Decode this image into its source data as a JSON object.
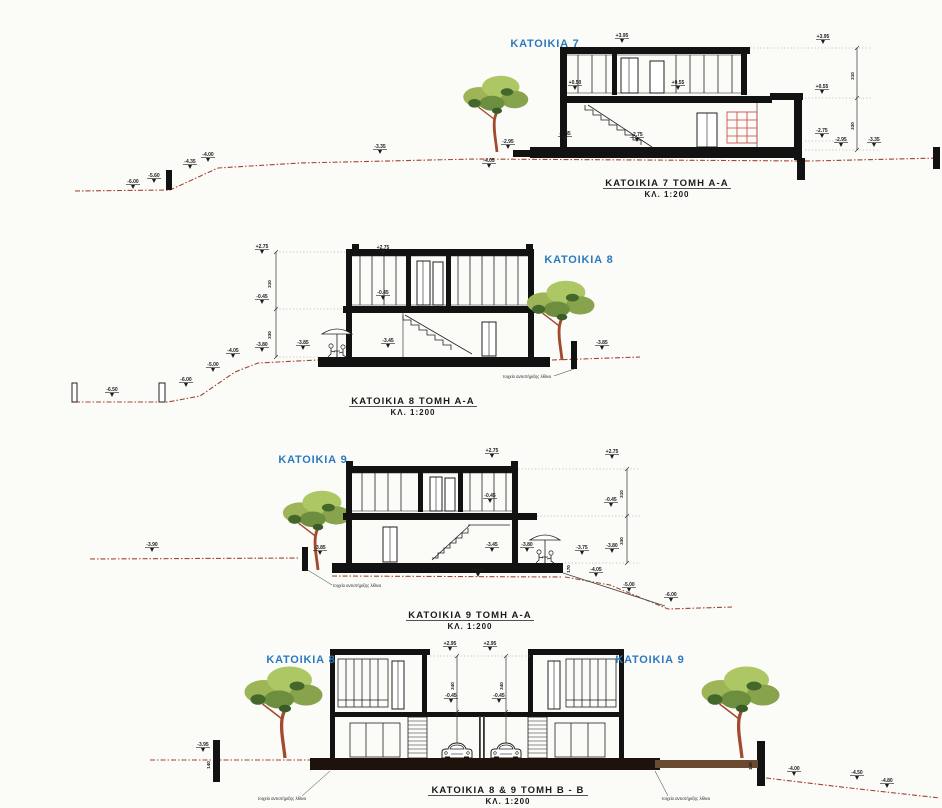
{
  "colors": {
    "accent_blue": "#2b7ac0",
    "terrain": "#a64431",
    "ink": "#121212",
    "red_hatch": "#c4413b"
  },
  "d1": {
    "house_label": "ΚΑΤΟΙΚΙΑ 7",
    "title": "ΚΑΤΟΙΚΙΑ 7  ΤΟΜΗ Α-Α",
    "scale": "ΚΛ. 1:200",
    "dims": [
      {
        "t": "310",
        "x": 854,
        "y": 76
      },
      {
        "t": "330",
        "x": 854,
        "y": 126
      }
    ],
    "markers": [
      {
        "t": "-6.00",
        "x": 133,
        "y": 183
      },
      {
        "t": "-5.60",
        "x": 154,
        "y": 177
      },
      {
        "t": "-4.35",
        "x": 190,
        "y": 163
      },
      {
        "t": "-4.00",
        "x": 208,
        "y": 156
      },
      {
        "t": "-3.35",
        "x": 380,
        "y": 148
      },
      {
        "t": "-2.95",
        "x": 508,
        "y": 143
      },
      {
        "t": "-4.05",
        "x": 489,
        "y": 162
      },
      {
        "t": "+3.95",
        "x": 622,
        "y": 37
      },
      {
        "t": "+3.95",
        "x": 823,
        "y": 38
      },
      {
        "t": "+0.50",
        "x": 575,
        "y": 84
      },
      {
        "t": "+0.55",
        "x": 678,
        "y": 84
      },
      {
        "t": "+0.55",
        "x": 822,
        "y": 88
      },
      {
        "t": "-2.85",
        "x": 565,
        "y": 135
      },
      {
        "t": "-2.75",
        "x": 637,
        "y": 136
      },
      {
        "t": "-2.75",
        "x": 822,
        "y": 132
      },
      {
        "t": "-2.95",
        "x": 841,
        "y": 141
      },
      {
        "t": "-3.35",
        "x": 874,
        "y": 141
      }
    ]
  },
  "d2": {
    "house_label": "ΚΑΤΟΙΚΙΑ 8",
    "title": "ΚΑΤΟΙΚΙΑ 8  ΤΟΜΗ Α-Α",
    "scale": "ΚΛ. 1:200",
    "note": "τοιχείο αντιστήριξης λίθινο",
    "dims": [
      {
        "t": "310",
        "x": 271,
        "y": 284
      },
      {
        "t": "330",
        "x": 271,
        "y": 335
      }
    ],
    "markers": [
      {
        "t": "-6.50",
        "x": 112,
        "y": 391
      },
      {
        "t": "-6.00",
        "x": 186,
        "y": 381
      },
      {
        "t": "-5.00",
        "x": 213,
        "y": 366
      },
      {
        "t": "-4.05",
        "x": 233,
        "y": 352
      },
      {
        "t": "-3.80",
        "x": 262,
        "y": 346
      },
      {
        "t": "-3.85",
        "x": 303,
        "y": 344
      },
      {
        "t": "+2.75",
        "x": 262,
        "y": 248
      },
      {
        "t": "+2.75",
        "x": 383,
        "y": 249
      },
      {
        "t": "-0.45",
        "x": 262,
        "y": 298
      },
      {
        "t": "-0.45",
        "x": 383,
        "y": 294
      },
      {
        "t": "-3.45",
        "x": 388,
        "y": 342
      },
      {
        "t": "-3.85",
        "x": 602,
        "y": 344
      }
    ]
  },
  "d3": {
    "house_label": "ΚΑΤΟΙΚΙΑ 9",
    "title": "ΚΑΤΟΙΚΙΑ 9  ΤΟΜΗ Α-Α",
    "scale": "ΚΛ. 1:200",
    "note": "τοιχείο αντιστήριξης λίθινο",
    "dims": [
      {
        "t": "310",
        "x": 623,
        "y": 494
      },
      {
        "t": "330",
        "x": 623,
        "y": 541
      },
      {
        "t": "170",
        "x": 570,
        "y": 569
      }
    ],
    "markers": [
      {
        "t": "-3.90",
        "x": 152,
        "y": 546
      },
      {
        "t": "-3.85",
        "x": 320,
        "y": 549
      },
      {
        "t": "+2.75",
        "x": 492,
        "y": 452
      },
      {
        "t": "+2.75",
        "x": 612,
        "y": 453
      },
      {
        "t": "-0.45",
        "x": 490,
        "y": 497
      },
      {
        "t": "-0.45",
        "x": 611,
        "y": 501
      },
      {
        "t": "-3.45",
        "x": 492,
        "y": 546
      },
      {
        "t": "-3.80",
        "x": 527,
        "y": 546
      },
      {
        "t": "-3.75",
        "x": 582,
        "y": 549
      },
      {
        "t": "-3.80",
        "x": 612,
        "y": 547
      },
      {
        "t": "-4.00",
        "x": 478,
        "y": 571
      },
      {
        "t": "-4.05",
        "x": 596,
        "y": 571
      },
      {
        "t": "-5.00",
        "x": 629,
        "y": 586
      },
      {
        "t": "-6.00",
        "x": 671,
        "y": 596
      }
    ]
  },
  "d4": {
    "house_label_left": "ΚΑΤΟΙΚΙΑ 8",
    "house_label_right": "ΚΑΤΟΙΚΙΑ 9",
    "title": "ΚΑΤΟΙΚΙΑ 8 & 9  ΤΟΜΗ Β - Β",
    "scale": "ΚΛ. 1:200",
    "note_left": "τοιχείο αντιστήριξης λίθινο",
    "note_right": "τοιχείο αντιστήριξης λίθινο",
    "dims": [
      {
        "t": "340",
        "x": 454,
        "y": 686
      },
      {
        "t": "340",
        "x": 503,
        "y": 686
      },
      {
        "t": "140",
        "x": 210,
        "y": 765
      },
      {
        "t": "140",
        "x": 752,
        "y": 766
      }
    ],
    "markers": [
      {
        "t": "-3.95",
        "x": 203,
        "y": 746
      },
      {
        "t": "+2.95",
        "x": 450,
        "y": 645
      },
      {
        "t": "+2.95",
        "x": 490,
        "y": 645
      },
      {
        "t": "-0.45",
        "x": 451,
        "y": 697
      },
      {
        "t": "-0.45",
        "x": 499,
        "y": 697
      },
      {
        "t": "-4.00",
        "x": 794,
        "y": 770
      },
      {
        "t": "-4.50",
        "x": 857,
        "y": 774
      },
      {
        "t": "-4.80",
        "x": 887,
        "y": 782
      }
    ]
  }
}
